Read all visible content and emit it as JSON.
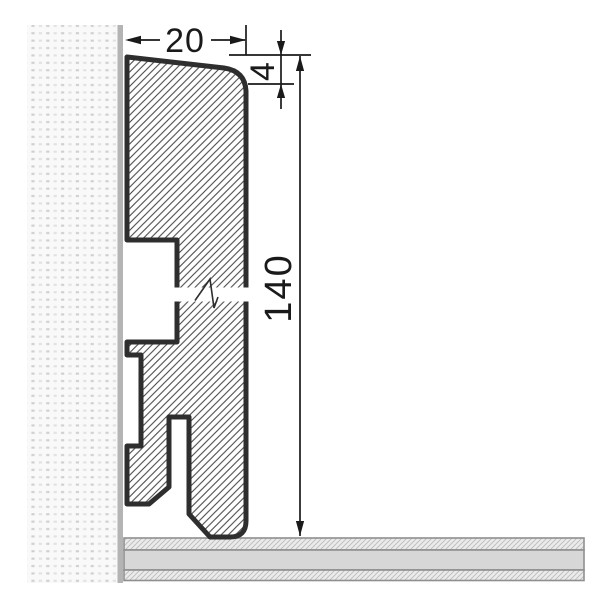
{
  "drawing": {
    "kind": "skirting-board-cross-section",
    "dims": {
      "width": "20",
      "bevel": "4",
      "height": "140"
    }
  },
  "colors": {
    "outline": "#2e2e2e",
    "dimension": "#1a1a1a",
    "wall_edge": "#b4b4b4",
    "wall_dot": "#d2d2d2",
    "floor_band": "#d7d7d7",
    "floor_border": "#8f8f8f"
  }
}
